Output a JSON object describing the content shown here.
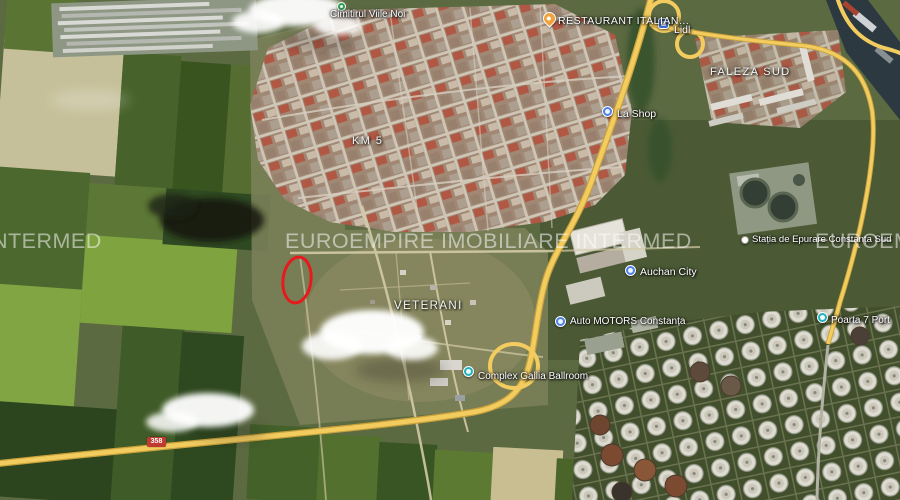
{
  "map": {
    "view": "satellite",
    "watermark": {
      "left": "NTERMED",
      "center": "EUROEMPIRE IMOBILIARE INTERMED",
      "right": "EUROEMP"
    },
    "labels": {
      "cemetery": "Cimitirul Viile Noi",
      "restaurant": "RESTAURANT ITALIAN...",
      "lidl": "Lidl",
      "faleza_sud": "FALEZA SUD",
      "km5": "KM 5",
      "shop": "La Shop",
      "epurare": "Stația de Epurare Constanța Sud",
      "auchan": "Auchan City",
      "motors": "Auto MOTORS Constanța",
      "veterani": "VETERANI",
      "gallia": "Complex Gallia Ballroom",
      "poarta7": "Poarta 7 Port"
    },
    "road_badge": {
      "text": "358",
      "color": "#bf3b30"
    },
    "annotation": {
      "shape": "ellipse",
      "color": "#e8191c"
    },
    "marker_colors": {
      "poi_blue": "#4a80e8",
      "restaurant_orange": "#efa33d",
      "cemetery_green": "#2f9e4f",
      "teal": "#23b0b8",
      "lidl_blue": "#3f6fd8",
      "road_yellow": "#f3cc60"
    }
  }
}
